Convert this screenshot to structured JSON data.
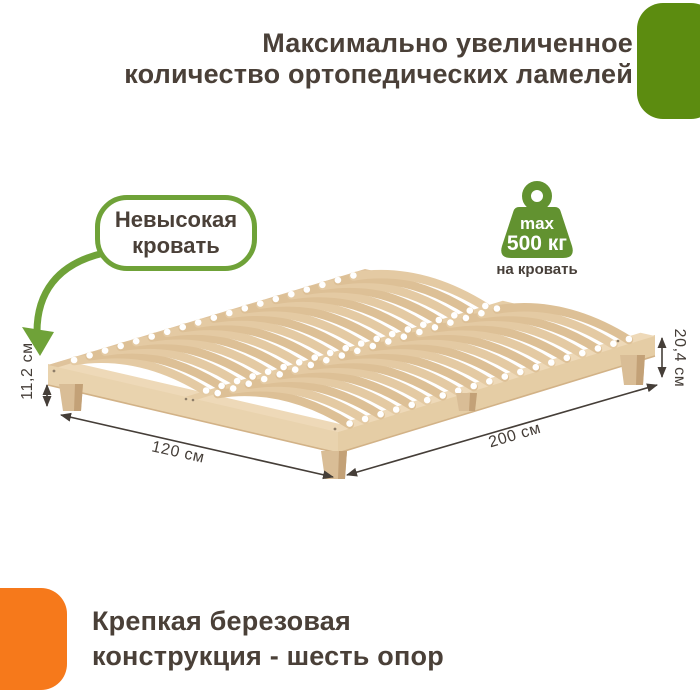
{
  "header": {
    "title_line1": "Максимально увеличенное",
    "title_line2": "количество ортопедических ламелей"
  },
  "callout": {
    "line1": "Невысокая",
    "line2": "кровать"
  },
  "weight_badge": {
    "max_label": "max",
    "weight": "500 кг",
    "caption": "на кровать"
  },
  "dimensions": {
    "bed_height": "11,2 см",
    "width": "120 см",
    "length": "200 см",
    "frame_height": "20,4 см"
  },
  "footer": {
    "line1": "Крепкая березовая",
    "line2": "конструкция - шесть опор"
  },
  "bed": {
    "slats_per_bank": 19,
    "banks": 2,
    "supports": 6
  },
  "colors": {
    "brand_green_block": "#5c8c10",
    "accent_green": "#6fa238",
    "accent_orange": "#f6791b",
    "text_dark": "#4a4038",
    "wood_light": "#eed9b8",
    "wood_mid": "#e4caa3",
    "wood_dark": "#d9bd96"
  }
}
